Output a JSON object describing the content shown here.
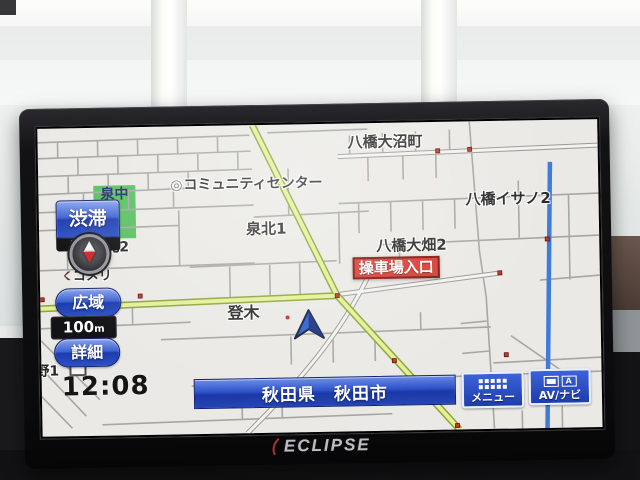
{
  "device": {
    "brand_logo": "ECLIPSE"
  },
  "screen": {
    "status": {
      "clock": "12:08",
      "traffic_label": "渋滞",
      "traffic_time": "12:03",
      "scale_value": "100",
      "scale_unit": "m"
    },
    "buttons": {
      "wide_area": "広域",
      "detail": "詳細",
      "menu": "メニュー",
      "av_navi": "AV/ナビ",
      "av_icon_letter": "A"
    },
    "location_bar": {
      "text": "秋田県　秋田市"
    },
    "intersection_badge": {
      "text": "操車場入口"
    },
    "map_labels": {
      "yabase_onumacho": "八橋大沼町",
      "community_center": "コミュニティセンター",
      "facility_glyph": "◎",
      "izumi_kita1": "泉北1",
      "yabase_isano2": "八橋イサノ2",
      "yabase_ohata2": "八橋大畑2",
      "noboriki": "登木",
      "izumi_chu": "泉中",
      "kita2": "北2",
      "komeri": "コメリ",
      "no1": "野1"
    },
    "colors": {
      "map_bg": "#eae9e5",
      "route_yellow": "#e4f094",
      "blue_road": "#3f7bd8",
      "green_area": "#55bf5e",
      "button_blue": "#2c50c8",
      "badge_red": "#d8382e"
    }
  }
}
